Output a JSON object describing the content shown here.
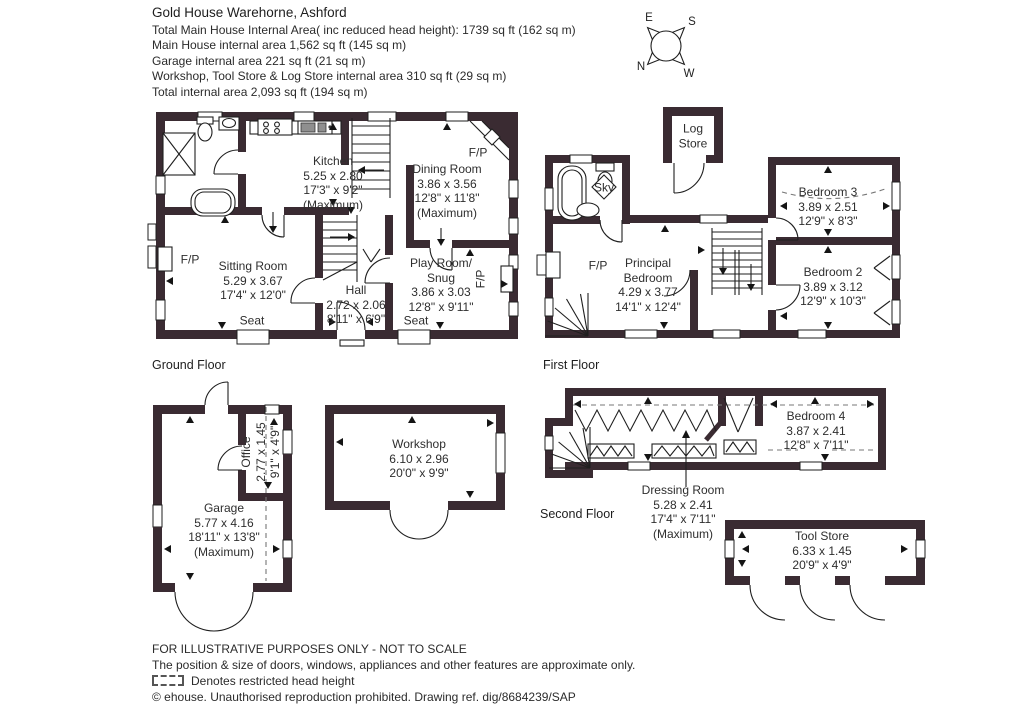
{
  "colors": {
    "wall": "#3a2b32",
    "line": "#1f1f1f",
    "text": "#2e2e2e"
  },
  "header": {
    "title": "Gold House Warehorne, Ashford",
    "lines": [
      "Total Main House Internal Area( inc reduced head height): 1739 sq ft (162 sq m)",
      "Main House internal area 1,562 sq ft (145 sq m)",
      "Garage internal area 221 sq ft (21 sq m)",
      "Workshop, Tool Store & Log Store internal area 310 sq ft (29 sq m)",
      "Total internal area 2,093 sq ft (194 sq m)"
    ]
  },
  "compass": {
    "n": "N",
    "e": "E",
    "s": "S",
    "w": "W"
  },
  "floor_labels": {
    "ground": "Ground Floor",
    "first": "First Floor",
    "second": "Second Floor"
  },
  "annotations": {
    "fireplace": "F/P",
    "seat": "Seat",
    "skylight": "Sky"
  },
  "rooms": {
    "kitchen": {
      "name": "Kitchen",
      "metric": "5.25 x 2.80",
      "imperial": "17'3\" x 9'2\"",
      "note": "(Maximum)"
    },
    "dining_room": {
      "name": "Dining Room",
      "metric": "3.86 x 3.56",
      "imperial": "12'8\" x 11'8\"",
      "note": "(Maximum)"
    },
    "sitting_room": {
      "name": "Sitting Room",
      "metric": "5.29 x 3.67",
      "imperial": "17'4\" x 12'0\""
    },
    "hall": {
      "name": "Hall",
      "metric": "2.72 x 2.06",
      "imperial": "8'11\" x 6'9\""
    },
    "play_room": {
      "name": "Play Room/",
      "name2": "Snug",
      "metric": "3.86 x 3.03",
      "imperial": "12'8\" x 9'11\""
    },
    "principal_bedroom": {
      "name": "Principal",
      "name2": "Bedroom",
      "metric": "4.29 x 3.77",
      "imperial": "14'1\" x 12'4\""
    },
    "bedroom2": {
      "name": "Bedroom 2",
      "metric": "3.89 x 3.12",
      "imperial": "12'9\" x 10'3\""
    },
    "bedroom3": {
      "name": "Bedroom 3",
      "metric": "3.89 x 2.51",
      "imperial": "12'9\" x 8'3\""
    },
    "bedroom4": {
      "name": "Bedroom 4",
      "metric": "3.87 x 2.41",
      "imperial": "12'8\" x 7'11\""
    },
    "dressing_room": {
      "name": "Dressing Room",
      "metric": "5.28 x 2.41",
      "imperial": "17'4\" x 7'11\"",
      "note": "(Maximum)"
    },
    "log_store": {
      "name": "Log",
      "name2": "Store"
    },
    "office": {
      "name": "Office",
      "metric": "2.77 x 1.45",
      "imperial": "9'1\" x 4'9\""
    },
    "garage": {
      "name": "Garage",
      "metric": "5.77 x 4.16",
      "imperial": "18'11\" x 13'8\"",
      "note": "(Maximum)"
    },
    "workshop": {
      "name": "Workshop",
      "metric": "6.10 x 2.96",
      "imperial": "20'0\" x 9'9\""
    },
    "tool_store": {
      "name": "Tool Store",
      "metric": "6.33 x 1.45",
      "imperial": "20'9\" x 4'9\""
    }
  },
  "footer": {
    "line1": "FOR ILLUSTRATIVE PURPOSES ONLY - NOT TO SCALE",
    "line2": "The position & size of doors, windows, appliances and other features are approximate only.",
    "key_label": "Denotes restricted head height",
    "line4": "© ehouse. Unauthorised reproduction prohibited. Drawing ref. dig/8684239/SAP"
  }
}
